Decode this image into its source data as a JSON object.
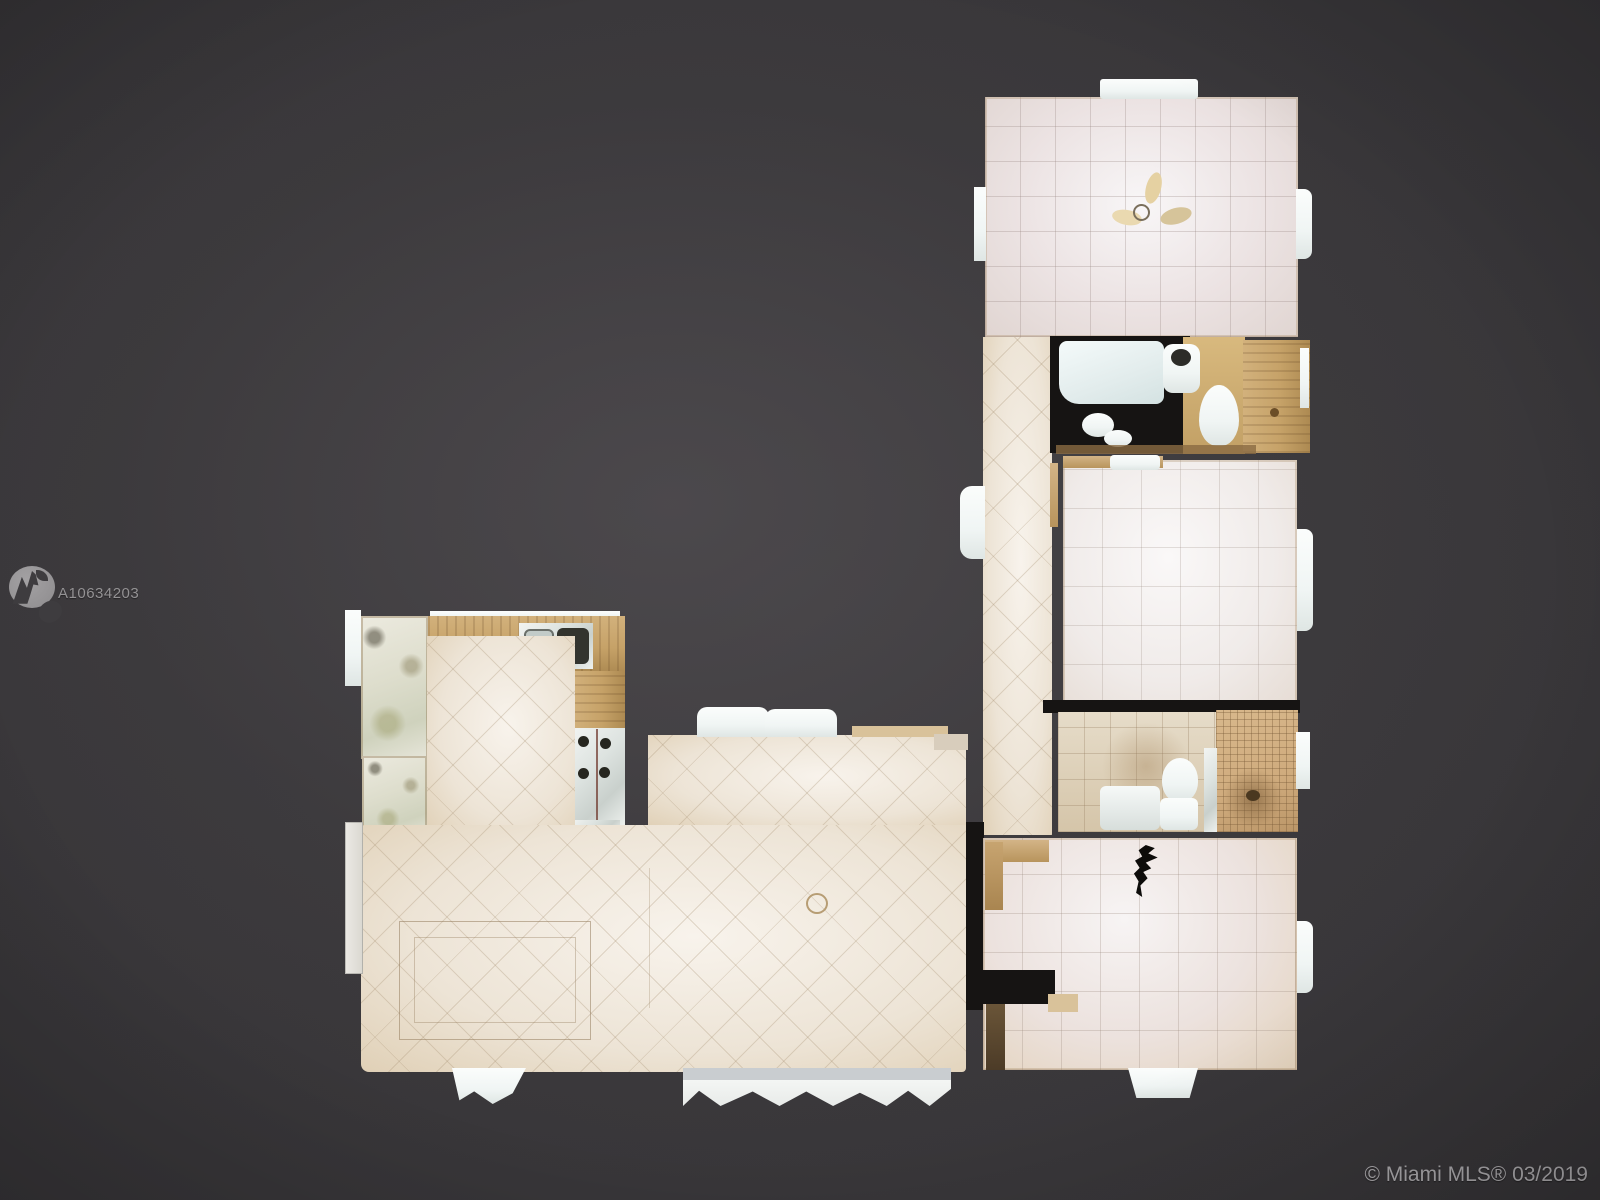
{
  "watermark": {
    "logo_name": "mountain-logo",
    "listing_id": "A10634203"
  },
  "footer": {
    "copyright": "© Miami MLS® 03/2019"
  },
  "colors": {
    "background_center": "#4a4649",
    "background_mid": "#3e3c3f",
    "background_edge": "#252427",
    "tile_cream": "#ede4d6",
    "tile_pink": "#ece3e3",
    "wood": "#c6a268",
    "mosaic": "#cfab7d",
    "fixture_white": "#f0f5f4",
    "wall_dark": "#161413",
    "watermark_gray": "#949294",
    "copyright_gray": "#aaa8ab"
  },
  "floorplan": {
    "type": "top-down-3d-scan-floor-plan",
    "rooms": [
      "bedroom-top",
      "bathroom-top",
      "bedroom-middle",
      "bathroom-middle",
      "bedroom-bottom",
      "hallway",
      "kitchen",
      "living-dining-room",
      "balconies"
    ]
  }
}
